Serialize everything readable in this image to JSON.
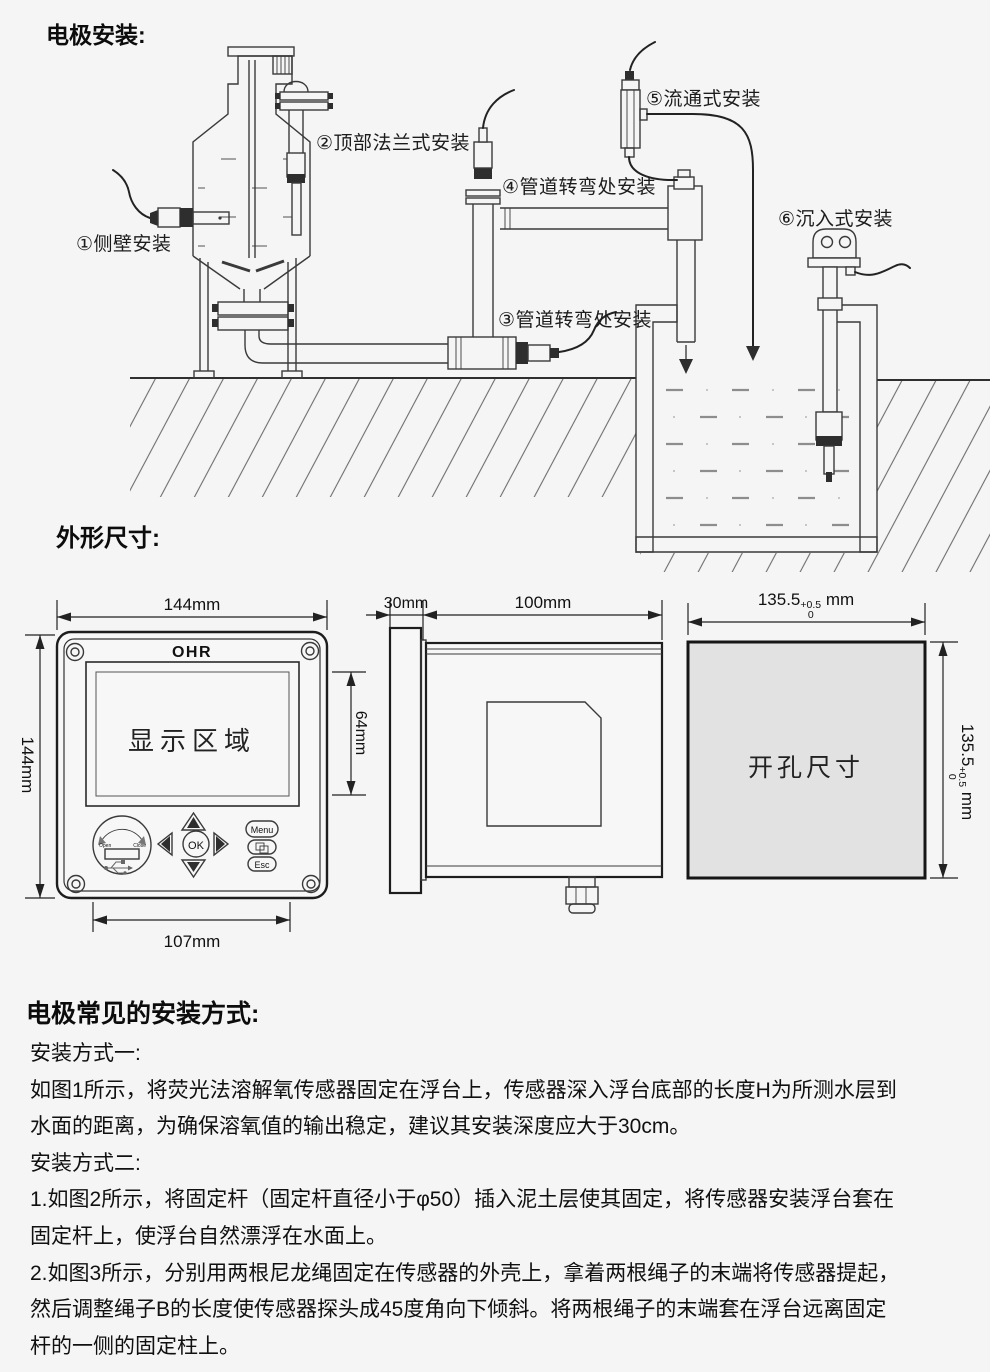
{
  "titles": {
    "install": "电极安装:",
    "dimensions": "外形尺寸:",
    "methods": "电极常见的安装方式:"
  },
  "install": {
    "labels": [
      "①侧壁安装",
      "②顶部法兰式安装",
      "③管道转弯处安装",
      "④管道转弯处安装",
      "⑤流通式安装",
      "⑥沉入式安装"
    ]
  },
  "front_view": {
    "brand": "OHR",
    "display_area": "显示区域",
    "ok": "OK",
    "menu": "Menu",
    "esc": "Esc",
    "usb_open": "Open",
    "usb_close": "Close",
    "dim_width": "144mm",
    "dim_height": "144mm",
    "dim_display_height": "64mm",
    "dim_bottom_width": "107mm"
  },
  "side_view": {
    "dim_bezel_depth": "30mm",
    "dim_body_depth": "100mm"
  },
  "cutout": {
    "label": "开孔尺寸",
    "dim_value": "135.5",
    "tol_plus": "+0.5",
    "tol_zero": "0",
    "unit": "mm"
  },
  "instructions": {
    "lines": [
      "安装方式一:",
      "如图1所示，将荧光法溶解氧传感器固定在浮台上，传感器深入浮台底部的长度H为所测水层到",
      "水面的距离，为确保溶氧值的输出稳定，建议其安装深度应大于30cm。",
      "安装方式二:",
      "1.如图2所示，将固定杆（固定杆直径小于φ50）插入泥土层使其固定，将传感器安装浮台套在",
      "固定杆上，使浮台自然漂浮在水面上。",
      "2.如图3所示，分别用两根尼龙绳固定在传感器的外壳上，拿着两根绳子的末端将传感器提起，",
      "然后调整绳子B的长度使传感器探头成45度角向下倾斜。将两根绳子的末端套在浮台远离固定",
      "杆的一侧的固定柱上。"
    ]
  }
}
